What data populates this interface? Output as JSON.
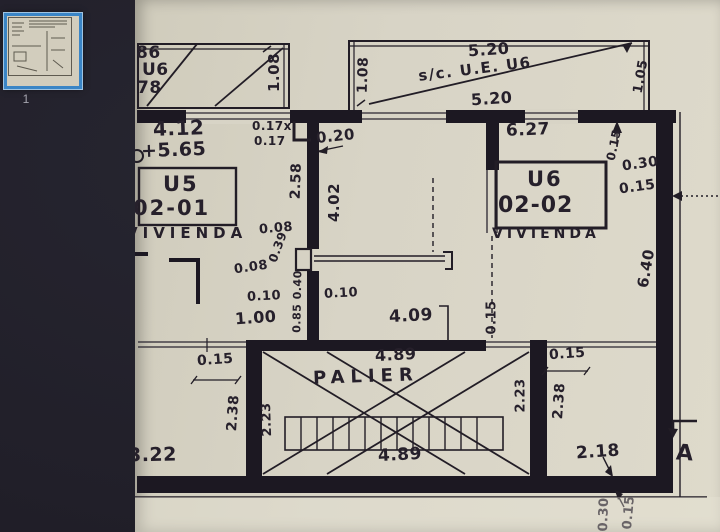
{
  "viewer": {
    "page_number": "1",
    "selected_thumb_border": "#3a85c6",
    "background": "#211f29",
    "paper_color": "#d8d4c6",
    "ink_color": "#221d26"
  },
  "plan": {
    "balcony_left": {
      "d1": "86",
      "d2": "U6",
      "d3": "78",
      "h": "1.08"
    },
    "balcony_right": {
      "top": "5.20",
      "label": "s/c. U.E. U6",
      "bottom": "5.20",
      "h": "1.08",
      "side": "1.05"
    },
    "unit_left": {
      "width": "4.12",
      "level": "+5.65",
      "code": "U5",
      "number": "02-01",
      "use": "VIVIENDA",
      "w1": "0.17x",
      "w2": "0.17",
      "depth": "2.58"
    },
    "center": {
      "w": "0.20",
      "depth": "4.02",
      "a": "0.08",
      "b": "0.39",
      "c": "0.08",
      "d": "0.10",
      "e": "1.00",
      "f": "0.85 0.40",
      "g": "0.10",
      "width": "4.09",
      "wall": "0.15"
    },
    "unit_right": {
      "width": "6.27",
      "code": "U6",
      "number": "02-02",
      "use": "VIVIENDA",
      "w1": "0.15",
      "w2": "0.30",
      "w3": "0.15",
      "depth": "6.40"
    },
    "palier": {
      "name": "PALIER",
      "top": "4.89",
      "bottom": "4.89",
      "left": "2.23",
      "right": "2.23"
    },
    "bottom_left": {
      "wall": "0.15",
      "depth": "2.38",
      "width": "3.22"
    },
    "bottom_right": {
      "wall": "0.15",
      "depth": "2.38",
      "width": "2.18",
      "b1": "0.30",
      "b2": "0.15",
      "section": "A"
    }
  }
}
